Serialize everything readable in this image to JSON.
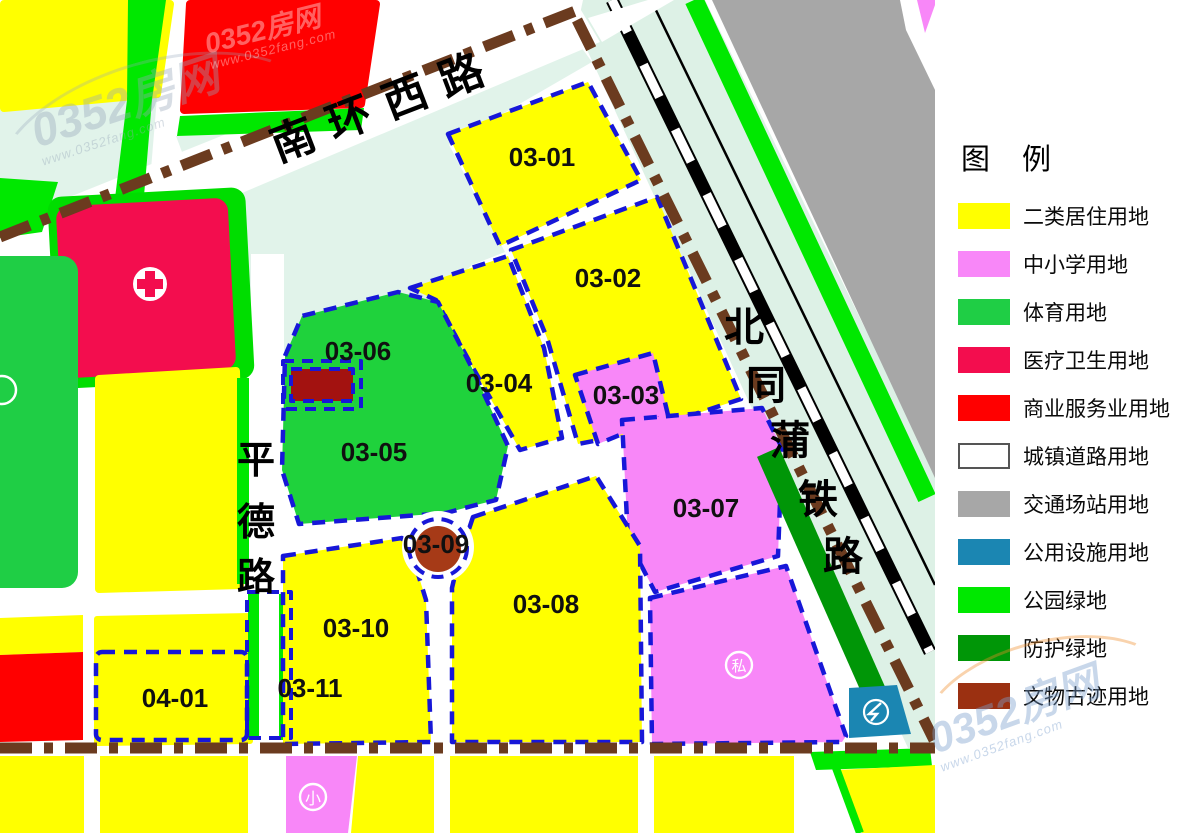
{
  "map": {
    "parcels": [
      {
        "id": "03-01"
      },
      {
        "id": "03-02"
      },
      {
        "id": "03-03"
      },
      {
        "id": "03-04"
      },
      {
        "id": "03-05"
      },
      {
        "id": "03-06"
      },
      {
        "id": "03-07"
      },
      {
        "id": "03-08"
      },
      {
        "id": "03-09"
      },
      {
        "id": "03-10"
      },
      {
        "id": "03-11"
      },
      {
        "id": "04-01"
      }
    ],
    "roads": {
      "nanhuanxi": "南环西路",
      "beitongpu": "北同蒲铁路",
      "pingde": "平德路"
    },
    "symbols": {
      "private_school_mark": "私",
      "primary_school_mark": "小"
    }
  },
  "legend": {
    "title": "图 例",
    "items": [
      {
        "label": "二类居住用地",
        "color": "#FFFF00"
      },
      {
        "label": "中小学用地",
        "color": "#F887F8"
      },
      {
        "label": "体育用地",
        "color": "#1FCE45"
      },
      {
        "label": "医疗卫生用地",
        "color": "#F30D4E"
      },
      {
        "label": "商业服务业用地",
        "color": "#FF0000"
      },
      {
        "label": "城镇道路用地",
        "color": "#FFFFFF"
      },
      {
        "label": "交通场站用地",
        "color": "#A7A7A7"
      },
      {
        "label": "公用设施用地",
        "color": "#1B86B2"
      },
      {
        "label": "公园绿地",
        "color": "#00E800"
      },
      {
        "label": "防护绿地",
        "color": "#009607"
      },
      {
        "label": "文物古迹用地",
        "color": "#9B3011"
      }
    ]
  },
  "watermark": {
    "brand": "0352房网",
    "url": "www.0352fang.com"
  }
}
